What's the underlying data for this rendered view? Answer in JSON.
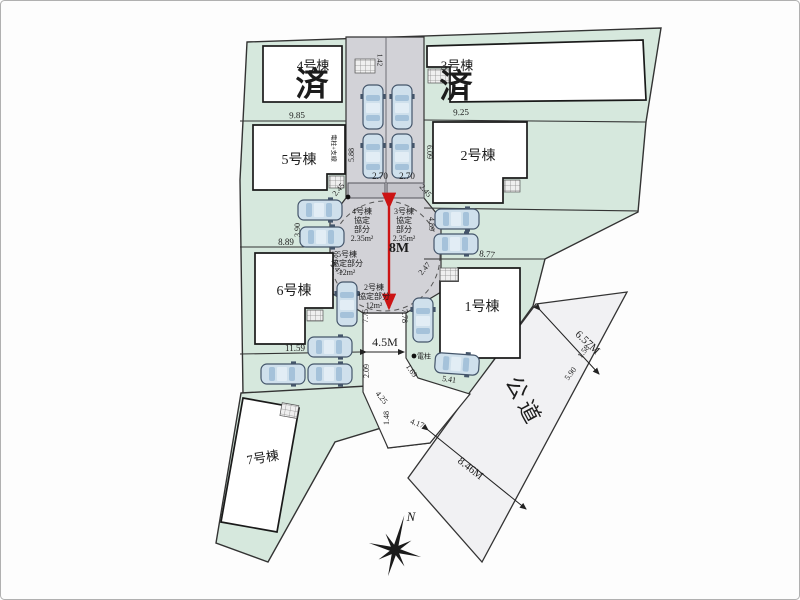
{
  "plan": {
    "buildings": [
      {
        "name": "1号棟",
        "sold": false
      },
      {
        "name": "2号棟",
        "sold": false
      },
      {
        "name": "3号棟",
        "sold": true
      },
      {
        "name": "4号棟",
        "sold": true
      },
      {
        "name": "5号棟",
        "sold": false
      },
      {
        "name": "6号棟",
        "sold": false
      },
      {
        "name": "7号棟",
        "sold": false
      }
    ],
    "sold_mark": "済",
    "public_road_name": "公道",
    "road_widths": [
      "8M",
      "4.5M",
      "6.57M",
      "8.46M"
    ],
    "compass_label": "N"
  },
  "colors": {
    "lot_green": "#d6e8dd",
    "road_gray": "#d2d2d7",
    "stall_gray": "#c4c4ca",
    "public_road": "#f1f1f3",
    "south_road": "#fcfcfc",
    "sold_red": "#a82222",
    "dim_red": "#cc1414",
    "line_dark": "#333333"
  },
  "labels": [
    {
      "n": "lot4-name",
      "t": "4号棟",
      "x": 313,
      "y": 67,
      "s": 13
    },
    {
      "n": "lot4-sold",
      "t": "済",
      "x": 312,
      "y": 88,
      "s": 33,
      "c": "#a82222",
      "b": 1
    },
    {
      "n": "lot3-name",
      "t": "3号棟",
      "x": 457,
      "y": 67,
      "s": 13
    },
    {
      "n": "lot3-sold",
      "t": "済",
      "x": 456,
      "y": 90,
      "s": 33,
      "c": "#a82222",
      "b": 1
    },
    {
      "n": "lot5-name",
      "t": "5号棟",
      "x": 299,
      "y": 161,
      "s": 14
    },
    {
      "n": "lot2-name",
      "t": "2号棟",
      "x": 478,
      "y": 157,
      "s": 14
    },
    {
      "n": "lot6-name",
      "t": "6号棟",
      "x": 294,
      "y": 292,
      "s": 14
    },
    {
      "n": "lot1-name",
      "t": "1号棟",
      "x": 482,
      "y": 308,
      "s": 14
    },
    {
      "n": "lot7-name",
      "t": "7号棟",
      "x": 263,
      "y": 459,
      "s": 13,
      "r": -9
    },
    {
      "n": "dim",
      "t": "9.85",
      "x": 297,
      "y": 116,
      "s": 9,
      "r": -2
    },
    {
      "n": "dim",
      "t": "9.25",
      "x": 461,
      "y": 113,
      "s": 9,
      "r": -2
    },
    {
      "n": "dim",
      "t": "1.42",
      "x": 379,
      "y": 60,
      "s": 7,
      "r": 90
    },
    {
      "n": "dim",
      "t": "5.88",
      "x": 352,
      "y": 155,
      "s": 8,
      "r": -90
    },
    {
      "n": "dim",
      "t": "6.09",
      "x": 429,
      "y": 152,
      "s": 8,
      "r": 90
    },
    {
      "n": "util-label",
      "t": "電柱+支線",
      "x": 333,
      "y": 148,
      "s": 6,
      "r": 90
    },
    {
      "n": "dim",
      "t": "2.70",
      "x": 380,
      "y": 177,
      "s": 9
    },
    {
      "n": "dim",
      "t": "2.70",
      "x": 407,
      "y": 177,
      "s": 9
    },
    {
      "n": "dim",
      "t": "2.45",
      "x": 339,
      "y": 190,
      "s": 8,
      "r": -50
    },
    {
      "n": "dim",
      "t": "2.45",
      "x": 425,
      "y": 191,
      "s": 8,
      "r": 50
    },
    {
      "n": "agreement",
      "t": "4号棟",
      "x": 362,
      "y": 212,
      "s": 8
    },
    {
      "n": "agreement",
      "t": "協定",
      "x": 362,
      "y": 221,
      "s": 8
    },
    {
      "n": "agreement",
      "t": "部分",
      "x": 362,
      "y": 230,
      "s": 8
    },
    {
      "n": "agreement",
      "t": "2.35m²",
      "x": 362,
      "y": 239,
      "s": 8
    },
    {
      "n": "agreement",
      "t": "3号棟",
      "x": 404,
      "y": 212,
      "s": 8
    },
    {
      "n": "agreement",
      "t": "協定",
      "x": 404,
      "y": 221,
      "s": 8
    },
    {
      "n": "agreement",
      "t": "部分",
      "x": 404,
      "y": 230,
      "s": 8
    },
    {
      "n": "agreement",
      "t": "2.35m²",
      "x": 404,
      "y": 239,
      "s": 8
    },
    {
      "n": "agreement",
      "t": "5号棟",
      "x": 347,
      "y": 255,
      "s": 8
    },
    {
      "n": "agreement",
      "t": "協定部分",
      "x": 347,
      "y": 264,
      "s": 8
    },
    {
      "n": "agreement",
      "t": "12m²",
      "x": 347,
      "y": 273,
      "s": 8
    },
    {
      "n": "agreement",
      "t": "2号棟",
      "x": 374,
      "y": 288,
      "s": 8
    },
    {
      "n": "agreement",
      "t": "協定部分",
      "x": 374,
      "y": 297,
      "s": 8
    },
    {
      "n": "agreement",
      "t": "12m²",
      "x": 374,
      "y": 306,
      "s": 8
    },
    {
      "n": "road-width-8m",
      "t": "8M",
      "x": 399,
      "y": 249,
      "s": 14,
      "c": "#cc1414",
      "b": 1
    },
    {
      "n": "dim",
      "t": "3.90",
      "x": 298,
      "y": 230,
      "s": 8,
      "r": -90
    },
    {
      "n": "dim",
      "t": "4.89",
      "x": 431,
      "y": 224,
      "s": 8,
      "r": 90
    },
    {
      "n": "dim",
      "t": "0.86",
      "x": 336,
      "y": 257,
      "s": 7,
      "r": -90
    },
    {
      "n": "dim",
      "t": "2.47",
      "x": 336,
      "y": 269,
      "s": 8,
      "r": 50
    },
    {
      "n": "dim",
      "t": "2.47",
      "x": 425,
      "y": 269,
      "s": 8,
      "r": -50
    },
    {
      "n": "dim",
      "t": "8.89",
      "x": 286,
      "y": 243,
      "s": 9
    },
    {
      "n": "dim",
      "t": "8.77",
      "x": 487,
      "y": 255,
      "s": 9,
      "r": 6
    },
    {
      "n": "dim",
      "t": "7.75",
      "x": 366,
      "y": 316,
      "s": 8,
      "r": -90
    },
    {
      "n": "dim",
      "t": "7.78",
      "x": 404,
      "y": 316,
      "s": 8,
      "r": 90
    },
    {
      "n": "road-width-45m",
      "t": "4.5M",
      "x": 385,
      "y": 343,
      "s": 12
    },
    {
      "n": "dim",
      "t": "11.59",
      "x": 295,
      "y": 349,
      "s": 9
    },
    {
      "n": "dim",
      "t": "2.09",
      "x": 367,
      "y": 371,
      "s": 8,
      "r": -90
    },
    {
      "n": "dim",
      "t": "4.25",
      "x": 381,
      "y": 398,
      "s": 8,
      "r": 50
    },
    {
      "n": "dim",
      "t": "1.48",
      "x": 387,
      "y": 418,
      "s": 8,
      "r": -90
    },
    {
      "n": "dim",
      "t": "4.17",
      "x": 417,
      "y": 424,
      "s": 8,
      "r": 20
    },
    {
      "n": "pole-label",
      "t": "電柱",
      "x": 424,
      "y": 357,
      "s": 7
    },
    {
      "n": "dim",
      "t": "1.69",
      "x": 411,
      "y": 371,
      "s": 8,
      "r": 55
    },
    {
      "n": "dim",
      "t": "5.41",
      "x": 449,
      "y": 380,
      "s": 8,
      "r": 8
    },
    {
      "n": "dim",
      "t": "5.90",
      "x": 571,
      "y": 374,
      "s": 8,
      "r": -53
    },
    {
      "n": "dim",
      "t": "1.58",
      "x": 584,
      "y": 352,
      "s": 8,
      "r": -53
    },
    {
      "n": "road-width-657",
      "t": "6.57M",
      "x": 587,
      "y": 343,
      "s": 11,
      "r": 43
    },
    {
      "n": "road-width-846",
      "t": "8.46M",
      "x": 470,
      "y": 469,
      "s": 11,
      "r": 38
    },
    {
      "n": "public-road-label",
      "t": "公道",
      "x": 522,
      "y": 403,
      "s": 22,
      "r": 62,
      "ls": 5
    },
    {
      "n": "compass-n-label",
      "t": "N",
      "x": 411,
      "y": 518,
      "s": 13,
      "i": 1
    }
  ],
  "arrows": [
    {
      "x1": 389,
      "y1": 207,
      "x2": 389,
      "y2": 308,
      "c": "#cc1414",
      "w": 2.4
    },
    {
      "x1": 366,
      "y1": 352,
      "x2": 404,
      "y2": 352,
      "c": "#222222",
      "w": 1
    },
    {
      "x1": 540,
      "y1": 310,
      "x2": 599,
      "y2": 374,
      "c": "#222222",
      "w": 1
    },
    {
      "x1": 428,
      "y1": 430,
      "x2": 526,
      "y2": 509,
      "c": "#222222",
      "w": 1
    }
  ],
  "poles": [
    {
      "x": 414,
      "y": 356
    },
    {
      "x": 348,
      "y": 197
    }
  ],
  "cars": [
    {
      "x": 373,
      "y": 107,
      "r": 0
    },
    {
      "x": 402,
      "y": 107,
      "r": 0
    },
    {
      "x": 373,
      "y": 156,
      "r": 0
    },
    {
      "x": 402,
      "y": 156,
      "r": 0
    },
    {
      "x": 320,
      "y": 210,
      "r": 90
    },
    {
      "x": 322,
      "y": 237,
      "r": 90
    },
    {
      "x": 347,
      "y": 304,
      "r": 0
    },
    {
      "x": 330,
      "y": 347,
      "r": 90
    },
    {
      "x": 283,
      "y": 374,
      "r": 90
    },
    {
      "x": 330,
      "y": 374,
      "r": 90
    },
    {
      "x": 457,
      "y": 219,
      "r": 90
    },
    {
      "x": 456,
      "y": 244,
      "r": 90
    },
    {
      "x": 423,
      "y": 320,
      "r": 0
    },
    {
      "x": 457,
      "y": 364,
      "r": 94
    }
  ],
  "compass": {
    "cx": 395,
    "cy": 550,
    "rot": 15
  }
}
